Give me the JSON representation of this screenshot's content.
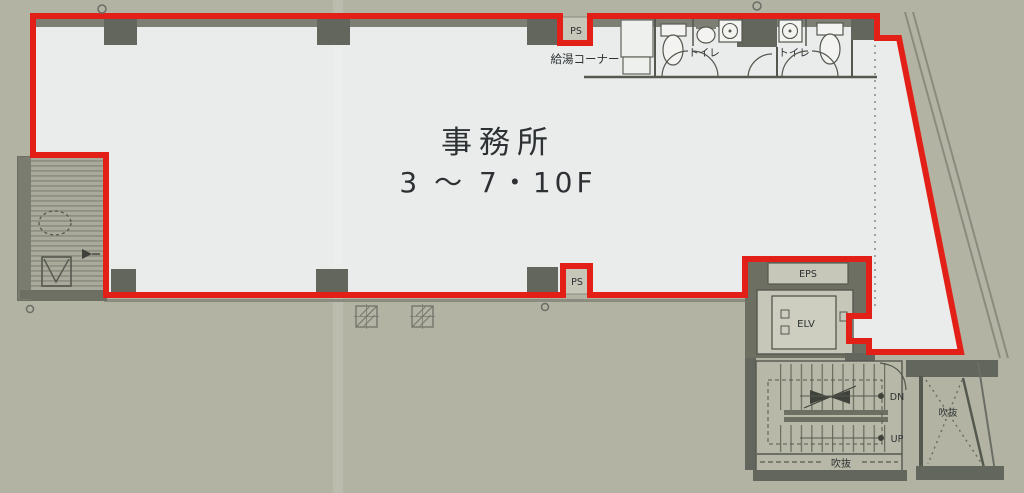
{
  "plan": {
    "type": "office-floor-plan",
    "labels": {
      "office_line1": "事務所",
      "office_line2": "3 〜 7・10F",
      "kitchenette": "給湯コーナー",
      "toilet_left": "トイレ",
      "toilet_right": "トイレ",
      "ps_top": "PS",
      "ps_bottom": "PS",
      "eps": "EPS",
      "elv": "ELV",
      "stair_down": "DN",
      "stair_up": "UP",
      "void_bottom": "吹抜",
      "void_right": "吹抜"
    },
    "colors": {
      "background": "#b2b3a3",
      "floor": "#e9eceb",
      "lease_outline": "#e32017",
      "wall_dark": "#63665c",
      "wall_line": "#55584f",
      "room_light": "#c6c7b8",
      "stair_floor": "#b7b8a8",
      "hatch_base": "#a9aa9b",
      "hatch_stripe": "#8f9082"
    }
  }
}
